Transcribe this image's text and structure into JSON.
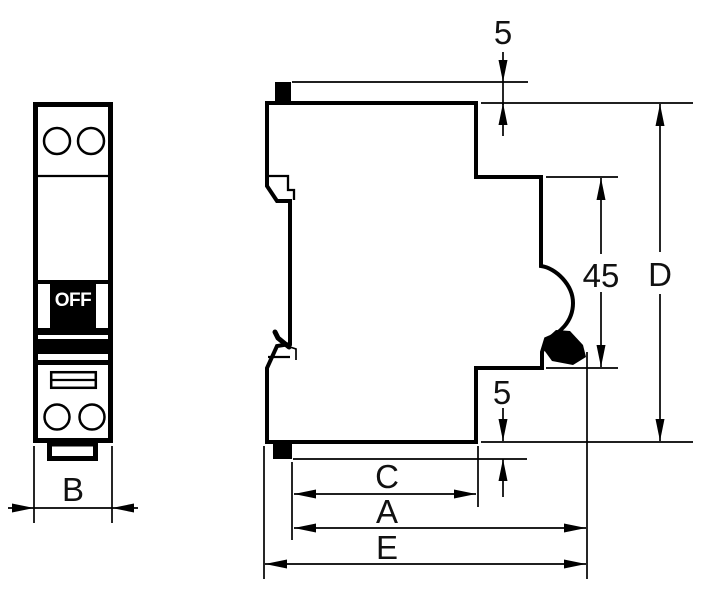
{
  "drawing": {
    "front_view": {
      "toggle_label": "OFF",
      "dim_width": "B"
    },
    "side_view": {
      "dim_top_protrusion": "5",
      "dim_recess_height": "45",
      "dim_total_height": "D",
      "dim_bottom_protrusion": "5",
      "dim_depth_c": "C",
      "dim_depth_a": "A",
      "dim_depth_e": "E"
    },
    "colors": {
      "background": "#ffffff",
      "line": "#000000",
      "label": "#111111",
      "toggle_fill": "#000000",
      "toggle_text": "#ffffff"
    }
  }
}
